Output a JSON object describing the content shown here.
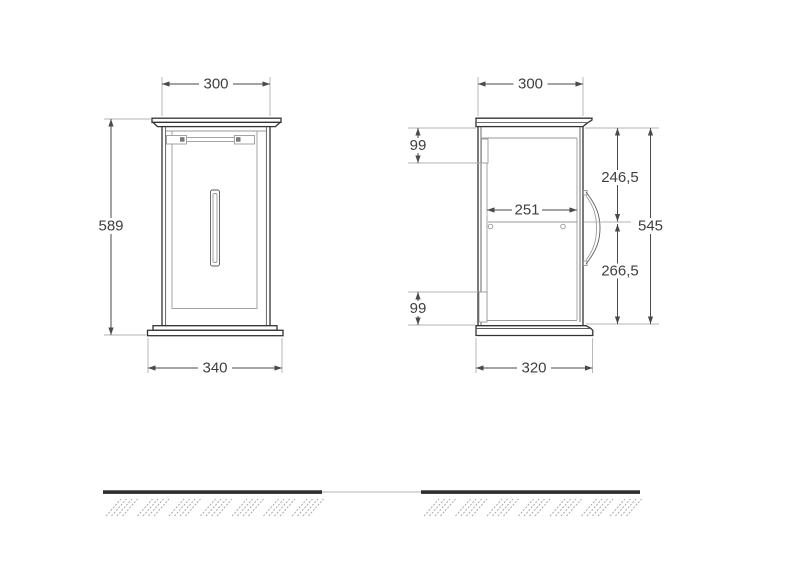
{
  "drawing_type": "cabinet dimension drawing",
  "front_view": {
    "dims": {
      "width": "300",
      "height": "589",
      "base_width": "340"
    }
  },
  "side_view": {
    "dims": {
      "depth": "300",
      "hang_rail_top": "99",
      "top_to_shelf": "246,5",
      "shelf_depth": "251",
      "body_height": "545",
      "shelf_to_bottom": "266,5",
      "hang_rail_bottom": "99",
      "base_depth": "320"
    }
  },
  "colors": {
    "outline": "#333333",
    "secondary": "#5a5a5a",
    "detail": "#999999",
    "extension": "#b3b3b3",
    "dimension": "#4a4a4a",
    "label_text": "#3f3f3f",
    "ground": "#2e2e2e",
    "hatch": "#9b9b9b",
    "background": "#ffffff"
  }
}
